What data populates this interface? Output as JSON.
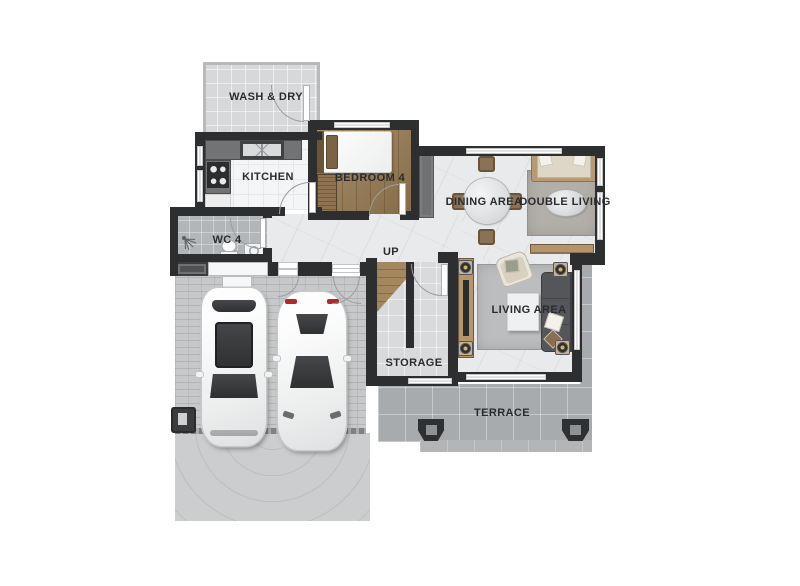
{
  "labels": {
    "wash_dry": "WASH & DRY",
    "kitchen": "KITCHEN",
    "bedroom4": "BEDROOM 4",
    "dining": "DINING AREA",
    "double_living": "DOUBLE LIVING",
    "wc4": "WC 4",
    "up": "UP",
    "storage": "STORAGE",
    "living": "LIVING AREA",
    "terrace": "TERRACE"
  },
  "colors": {
    "wall": "#2d2e30",
    "wood_floor": "#97794f",
    "marble_floor": "#e9eaec",
    "terrace_floor": "#a8abad",
    "paver_floor": "#c6c8ca",
    "label_text": "#2a2b2d"
  }
}
